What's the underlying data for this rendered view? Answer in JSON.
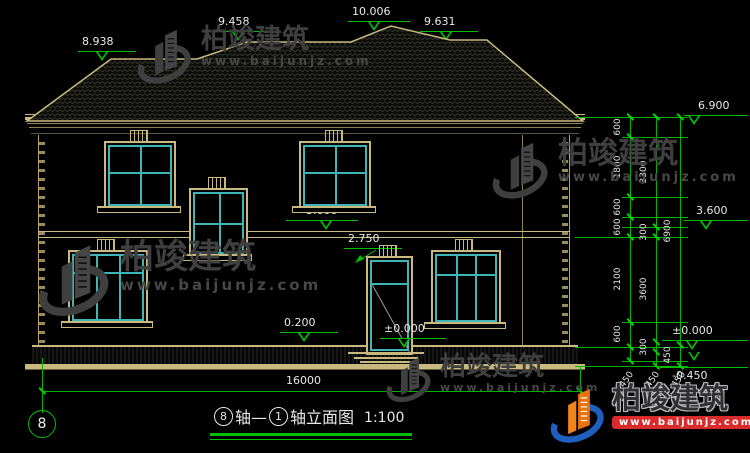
{
  "drawing": {
    "markers": {
      "ridge_left": "8.938",
      "ridge_mid_left": "9.458",
      "ridge_top": "10.006",
      "ridge_right": "9.631",
      "eave_right": "6.900",
      "floor2_mid": "3.600",
      "door_top": "2.750",
      "plinth": "0.200",
      "ground_door": "±0.000",
      "floor2_right": "3.600",
      "ground_right": "±0.000",
      "footing_right": "-0.450"
    },
    "right_dims": {
      "inner": [
        "600",
        "1800",
        "600",
        "600",
        "2100",
        "600"
      ],
      "inner_bottom": "450",
      "mid": [
        "3300",
        "300",
        "3600",
        "300"
      ],
      "mid_bottom": "450",
      "outer": [
        "6900",
        "450"
      ],
      "outer_bottom": "450"
    },
    "width_dim": "16000",
    "axis_bubble": "8"
  },
  "title_block": {
    "axis_from": "8",
    "axis_from_suffix": "轴—",
    "axis_to": "1",
    "axis_to_suffix": "轴立面图",
    "scale": "1:100"
  },
  "watermark": {
    "brand": "柏竣建筑",
    "url": "www.baijunjz.com"
  },
  "footer_logo": {
    "brand": "柏竣建筑",
    "url": "www.baijunjz.com"
  },
  "colors": {
    "line_tan": "#c9b97e",
    "line_cyan": "#3fb5b5",
    "dim_green": "#00c000",
    "text_white": "#e8e8e8",
    "logo_blue": "#1e5fc0",
    "logo_orange": "#f08519",
    "logo_red": "#d92b2b"
  }
}
